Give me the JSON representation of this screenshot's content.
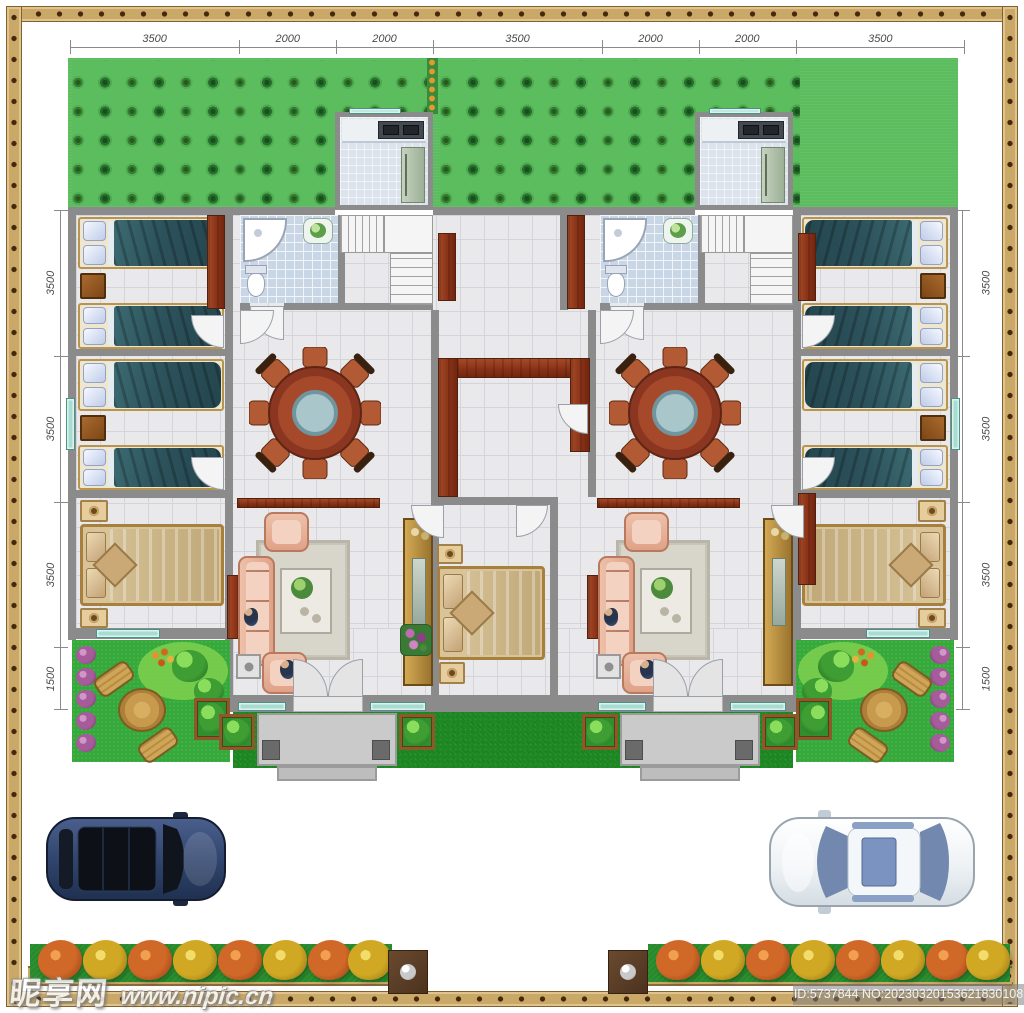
{
  "page": {
    "type": "residential-duplex-floor-plan"
  },
  "dimensions": {
    "top": [
      "3500",
      "2000",
      "2000",
      "3500",
      "2000",
      "2000",
      "3500"
    ],
    "left": [
      "3500",
      "3500",
      "3500",
      "1500"
    ],
    "right": [
      "3500",
      "3500",
      "3500",
      "1500"
    ]
  },
  "watermarks": {
    "site_name": "昵享网",
    "site_url": "www.nipic.cn",
    "stock_id": "ID:5737844 NO:20230320153621830108"
  },
  "colors": {
    "frame": "#c9a868",
    "frame_dot": "#46290d",
    "wall_gray": "#8b8b8b",
    "floor_tile": "#e9e9ec",
    "bath_tile": "#c9d6e6",
    "wood_dark_red": "#8a3218",
    "twin_blanket_teal": "#2c525b",
    "master_bed_gold": "#cdb88c",
    "sofa_pink": "#e8b29c",
    "orchard_green": "#5cbd5e",
    "front_lawn_green": "#1f8b24",
    "side_lawn_green": "#35a93a",
    "hedge_green": "#2c9231",
    "bush_red": "#d06828",
    "bush_yellow": "#d0a824",
    "window_teal": "#a8dbd2",
    "suv_blue": "#31466e",
    "sedan_white": "#f2f4f6",
    "porch_gray": "#cacaca"
  },
  "icons": {
    "left_vehicle": "suv-top-view-icon",
    "right_vehicle": "sedan-top-view-icon",
    "gate_post": "gate-post-icon",
    "corner_shower": "corner-shower-icon",
    "toilet": "toilet-icon",
    "dining_set": "round-dining-table-icon",
    "sofa_set": "sofa-set-icon",
    "staircase": "staircase-icon",
    "patio_set": "garden-table-icon",
    "orchard": "tree-grid-pattern",
    "street_hedge": "flower-bush-row"
  }
}
